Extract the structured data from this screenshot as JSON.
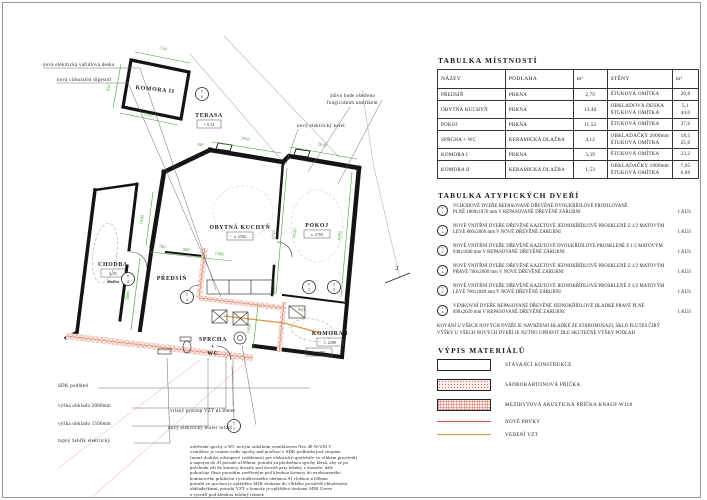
{
  "colors": {
    "dim_green": "#4aa03c",
    "new_red": "#c65b49",
    "vzt_orange": "#d99a3d"
  },
  "plan": {
    "rooms": {
      "komora2": "KOMORA II",
      "terasa": {
        "name": "TERASA",
        "level": "+ 0,14"
      },
      "chodba": {
        "name": "CHODBA",
        "area": "6,85",
        "floor": "dlažba"
      },
      "predsin": "PŘEDSÍŇ",
      "kuchyn": {
        "name": "OBYTNÁ KUCHYŇ",
        "height": "v. 2765"
      },
      "pokoj": {
        "name": "POKOJ",
        "height": "v. 2765"
      },
      "sprcha": {
        "l1": "SPRCHA",
        "l2": "+",
        "l3": "WC"
      },
      "komora1": {
        "name": "KOMORA I",
        "h1": "v. 2390",
        "h2": "v. 1780"
      }
    },
    "dims": [
      "750",
      "950",
      "1150",
      "2450",
      "2610",
      "1430",
      "780",
      "900",
      "1100",
      "2080",
      "4745",
      "4120",
      "4190",
      "1500",
      "800",
      "180"
    ],
    "door_tags": [
      {
        "letter": "T",
        "num": "1"
      },
      {
        "letter": "T",
        "num": "2"
      },
      {
        "letter": "T",
        "num": "3"
      },
      {
        "letter": "T",
        "num": "4"
      },
      {
        "letter": "T",
        "num": "5"
      },
      {
        "letter": "T",
        "num": "6"
      }
    ],
    "section_mark": "2",
    "annotations": {
      "top": [
        "nová elektrická vařidlová deska",
        "nová cirkulační digestoř",
        "zdivo bude ošetřeno",
        "fungicidním nástřikem",
        "nový elektrický kotel"
      ],
      "left": [
        "SDK podhled",
        "výška obkladu 2000mm",
        "výška obkladu 1500mm",
        "topný žebřík elektrický"
      ],
      "callouts": [
        "vrtaný prostup VZT ø130mm",
        "nový elektrický boiler ležatý"
      ]
    },
    "paragraph": [
      "odvětrání sprchy a WC novým radiálním ventilátorem Nex 48 W/230 V",
      "ventilátor je osazen vedle sprchy nad pračkou v SDK podhledu pod stropem",
      "(nutné dodržet odstupové vzdálenosti pro elektrické spotřebiče ve vlhkém prostředí)",
      "a napojen do Al potrubí ø100mm, potrubí za předstěnou sprchy klesá, aby se po",
      "průchodu zdí do komory dostalo pod úroveň paty klenby v komoře, dále",
      "pokračuje flexo potrubím zavěšeným pod klenbou komory do neobsazeného",
      "komínového průduchu vyvložkovaného ohebnou Al vložkou ø140mm",
      "potrubí za sprchou je opláštěno SDK deskami do vlhkého prostředí obloženými",
      "obkladačkami, potrubí VZT v komoře je opláštěno deskami SDK Green",
      "a vytváří pod klenbou falešný trámek"
    ]
  },
  "tables": {
    "rooms": {
      "title": "TABULKA MÍSTNOSTÍ",
      "headers": [
        "NÁZEV",
        "PODLAHA",
        "m²",
        "STĚNY",
        "m²"
      ],
      "rows": [
        {
          "name": "PŘEDSÍŇ",
          "floor": "PRKNA",
          "area": "2,79",
          "wall1": "ŠTUKOVÁ OMÍTKA",
          "warea1": "20,8"
        },
        {
          "name": "OBYTNÁ KUCHYŇ",
          "floor": "PRKNA",
          "area": "13,40",
          "wall1": "OBKLADOVÁ DESKA",
          "warea1": "5,1",
          "wall2": "ŠTUKOVÁ OMÍTKA",
          "warea2": "44,0"
        },
        {
          "name": "POKOJ",
          "floor": "PRKNA",
          "area": "11,52",
          "wall1": "ŠTUKOVÁ OMÍTKA",
          "warea1": "37,6"
        },
        {
          "name": "SPRCHA + WC",
          "floor": "KERAMICKÁ DLAŽBA",
          "area": "4,12",
          "wall1": "OBKLADAČKY 2000mm",
          "warea1": "18,5",
          "wall2": "ŠTUKOVÁ OMÍTKA",
          "warea2": "25,6"
        },
        {
          "name": "KOMORA I",
          "floor": "PRKNA",
          "area": "3,39",
          "wall1": "ŠTUKOVÁ OMÍTKA",
          "warea1": "23,2"
        },
        {
          "name": "KOMORA II",
          "floor": "KERAMICKÁ DLAŽBA",
          "area": "1,53",
          "wall1": "OBKLADAČKY 1900mm",
          "warea1": "7,95",
          "wall2": "ŠTUKOVÁ OMÍTKA",
          "warea2": "6,68"
        }
      ]
    },
    "doors": {
      "title": "TABULKA ATYPICKÝCH DVEŘÍ",
      "items": [
        {
          "letter": "T",
          "num": "1",
          "line1": "VCHODOVÉ DVEŘE REPASOVANÉ DŘEVĚNÉ DVOUKŘÍDLOVÉ PROFILOVANÉ",
          "line2": "PLNÉ 1000x1870 mm V REPASOVANÉ DŘEVĚNÉ ZÁRUBNI",
          "count": "1 KUS"
        },
        {
          "letter": "T",
          "num": "2",
          "line1": "NOVÉ VNITŘNÍ DVEŘE DŘEVĚNÉ KAZETOVÉ JEDNOKŘÍDLOVÉ PROSKLENÉ Z 1/2 MATOVÝM",
          "line2": "LEVÉ 800x2000 mm V NOVÉ DŘEVĚNÉ ZÁRUBNI",
          "count": "1 KUS"
        },
        {
          "letter": "T",
          "num": "3",
          "line1": "NOVÉ VNITŘNÍ DVEŘE DŘEVĚNÉ KAZETOVÉ DVOUKŘÍDLOVÉ PROSKLENÉ Z 1/2 MATOVÝM",
          "line2": "940x1840 mm V REPASOVANÉ DŘEVĚNÉ ZÁRUBNI",
          "count": "1 KUS"
        },
        {
          "letter": "T",
          "num": "4",
          "line1": "NOVÉ VNITŘNÍ DVEŘE DŘEVĚNÉ KAZETOVÉ JEDNOKŘÍDLOVÉ PROSKLENÉ Z 1/2 MATOVÝM",
          "line2": "PRAVÉ 700x2000 mm V NOVÉ DŘEVĚNÉ ZÁRUBNI",
          "count": "1 KUS"
        },
        {
          "letter": "T",
          "num": "5",
          "line1": "NOVÉ VNITŘNÍ DVEŘE DŘEVĚNÉ KAZETOVÉ JEDNOKŘÍDLOVÉ PROSKLENÉ Z 1/2 MATOVÝM",
          "line2": "LEVÉ 700x1840 mm V NOVÉ DŘEVĚNÉ ZÁRUBNI",
          "count": "1 KUS"
        },
        {
          "letter": "T",
          "num": "6",
          "line1": "VENKOVNÍ DVEŘE REPASOVANÉ DŘEVĚNÉ JEDNOKŘÍDLOVÉ HLADKÉ PRAVÉ PLNÉ",
          "line2": "690x2020 mm V REPASOVANÉ DŘEVĚNÉ ZÁRUBNI",
          "count": "1 KUS"
        }
      ],
      "notes": [
        "KOVÁNÍ U VŠECH NOVÝCH DVEŘÍ JE NAVRŽENO HLADKÉ ZE STAROMOSAZI, SKLO FLUTES ČIRÝ",
        "VÝŠKY U VŠECH NOVÝCH DVEŘÍ JE NUTNO UPRAVIT DLE SKUTEČNÉ VÝŠKY PODLAH"
      ]
    },
    "materials": {
      "title": "VÝPIS MATERIÁLŮ",
      "items": [
        {
          "label": "STÁVAJÍCÍ KONSTRUKCE"
        },
        {
          "label": "SÁDROKARTONOVÁ PŘÍČKA"
        },
        {
          "label": "MEZIBYTOVÁ AKUSTICKÁ PŘÍČKA KNAUF W118"
        },
        {
          "label": "NOVÉ PRVKY"
        },
        {
          "label": "VEDENÍ VZT"
        }
      ]
    }
  }
}
